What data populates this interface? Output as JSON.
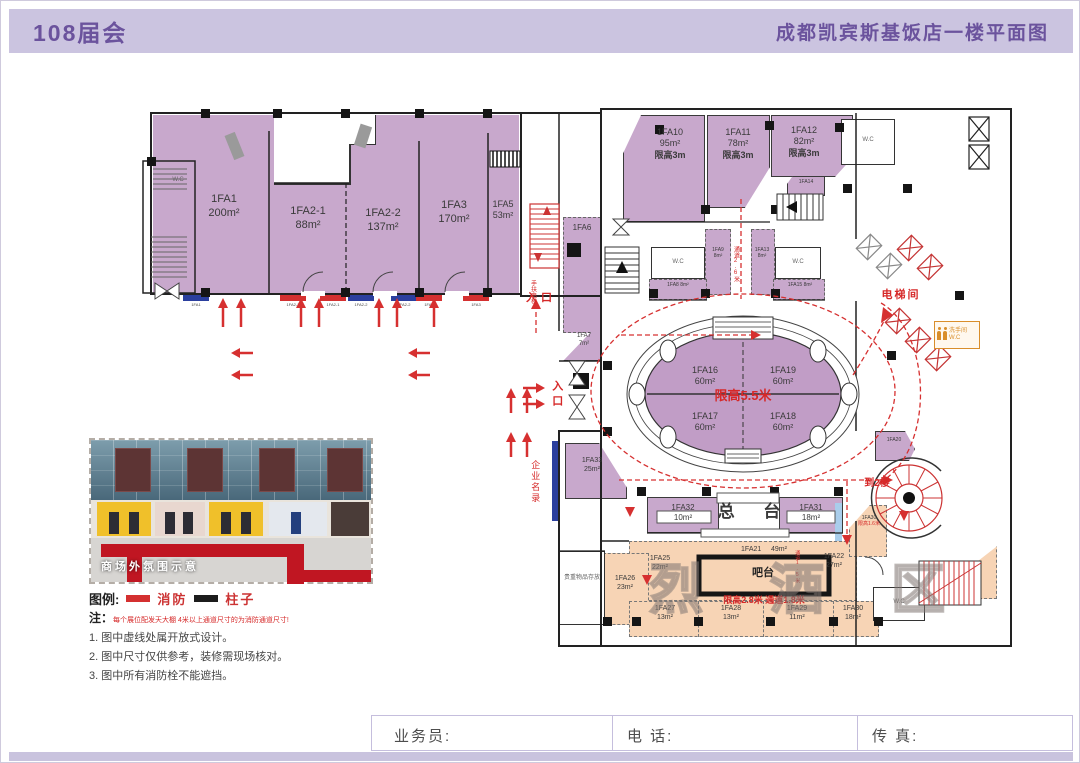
{
  "colors": {
    "header_bg": "#cbc4e0",
    "title_color": "#6b539d",
    "room_purple": "#c8a8cc",
    "zone_pink": "#f7d4b5",
    "red": "#d62828",
    "footer_strip": "#c9c3de"
  },
  "header": {
    "left_title": "108届会",
    "right_title": "成都凯宾斯基饭店一楼平面图"
  },
  "plan": {
    "labels": {
      "entrance": "入口",
      "entrance_vertical": "入口",
      "escalator": "手扶电梯",
      "elevator_hall": "电梯间",
      "to_2nd_floor": "到2楼",
      "company_directory": "企业名录",
      "reception": "总 台",
      "bar_counter": "吧台",
      "valuables": "贵重物品存放",
      "spirits_watermark": "烈 酒 区",
      "corridor_26": "通道2.6米",
      "corridor_15": "通道1.5米",
      "oval_limit": "限高5.5米",
      "bar_zone_limit": "限高2.8米 通道1.8米",
      "wc": "W.C",
      "restroom": "洗手间",
      "restroom_wc": "W.C"
    },
    "rooms": {
      "left_wing": [
        {
          "id": "1FA1",
          "area": "200m²"
        },
        {
          "id": "1FA2-1",
          "area": "88m²"
        },
        {
          "id": "1FA2-2",
          "area": "137m²"
        },
        {
          "id": "1FA3",
          "area": "170m²"
        },
        {
          "id": "1FA5",
          "area": "53m²"
        }
      ],
      "top_row": [
        {
          "id": "1FA10",
          "area": "95m²",
          "limit": "限高3m"
        },
        {
          "id": "1FA11",
          "area": "78m²",
          "limit": "限高3m"
        },
        {
          "id": "1FA12",
          "area": "82m²",
          "limit": "限高3m"
        }
      ],
      "small": [
        {
          "id": "1FA6"
        },
        {
          "id": "1FA7",
          "area": "7m²"
        },
        {
          "id": "1FA8",
          "area": "8m²"
        },
        {
          "id": "1FA9",
          "area": "8m²"
        },
        {
          "id": "1FA13",
          "area": "8m²"
        },
        {
          "id": "1FA14"
        },
        {
          "id": "1FA15",
          "area": "8m²"
        },
        {
          "id": "1FA20"
        }
      ],
      "oval": [
        {
          "id": "1FA16",
          "area": "60m²"
        },
        {
          "id": "1FA19",
          "area": "60m²"
        },
        {
          "id": "1FA17",
          "area": "60m²"
        },
        {
          "id": "1FA18",
          "area": "60m²"
        }
      ],
      "reception_row": [
        {
          "id": "1FA32",
          "area": "10m²"
        },
        {
          "id": "1FA31",
          "area": "18m²"
        },
        {
          "id": "1FA33",
          "area": "25m²"
        }
      ],
      "spirits": [
        {
          "id": "1FA25",
          "area": "22m²"
        },
        {
          "id": "1FA21",
          "area": "49m²"
        },
        {
          "id": "1FA22",
          "area": "27m²"
        },
        {
          "id": "1FA26",
          "area": "23m²"
        },
        {
          "id": "1FA27",
          "area": "13m²"
        },
        {
          "id": "1FA28",
          "area": "13m²"
        },
        {
          "id": "1FA29",
          "area": "11m²"
        },
        {
          "id": "1FA30",
          "area": "18m²"
        }
      ],
      "ramp": {
        "id": "1FA30",
        "limit": "限高1.6米"
      }
    },
    "booth_markers": [
      {
        "label": "1FA1",
        "color": "blue"
      },
      {
        "label": "1FA2-1",
        "color": "red"
      },
      {
        "label": "1FA2-1",
        "color": "red"
      },
      {
        "label": "1FA2-2",
        "color": "blue"
      },
      {
        "label": "1FA2-2",
        "color": "blue"
      },
      {
        "label": "1FA3",
        "color": "red"
      },
      {
        "label": "1FA3",
        "color": "red"
      }
    ]
  },
  "photo": {
    "caption": "商场外氛围示意"
  },
  "legend": {
    "title": "图例:",
    "fire": "消防",
    "column": "柱子"
  },
  "notes": {
    "prefix": "注：",
    "red_note": "每个展位配发天大棚 4米以上通道尺寸的为消防通道尺寸!",
    "items": [
      "1. 图中虚线处属开放式设计。",
      "2. 图中尺寸仅供参考，装修需现场核对。",
      "3. 图中所有消防栓不能遮挡。"
    ]
  },
  "footer": {
    "salesperson": "业务员:",
    "phone": "电 话:",
    "fax": "传 真:"
  }
}
